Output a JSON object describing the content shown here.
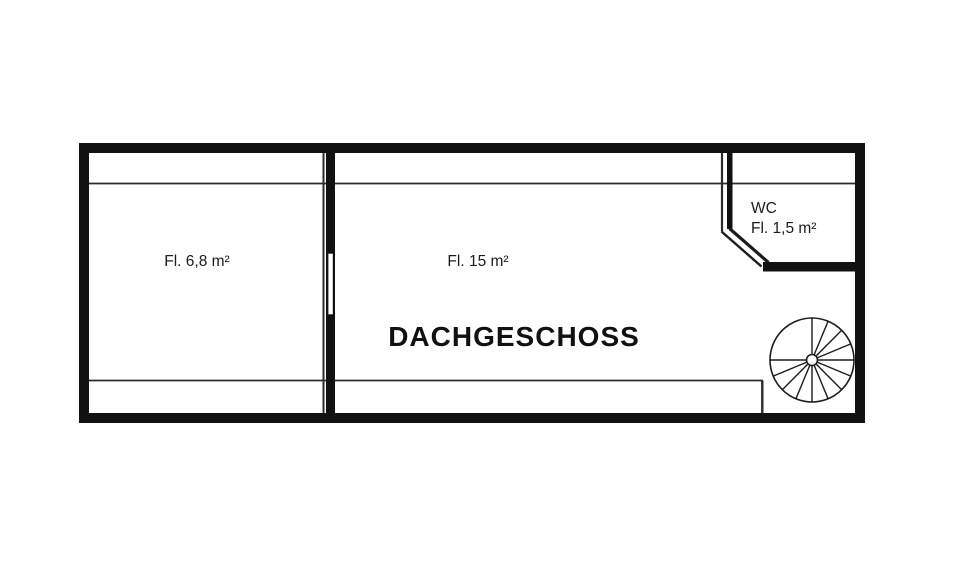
{
  "plan": {
    "title": "DACHGESCHOSS",
    "rooms": [
      {
        "name": "left-room",
        "label": "Fl. 6,8 m²"
      },
      {
        "name": "main-room",
        "label": "Fl. 15 m²"
      },
      {
        "name": "wc",
        "label": "WC",
        "area_label": "Fl. 1,5 m²"
      }
    ],
    "features": [
      {
        "name": "spiral-staircase"
      },
      {
        "name": "door-opening-main-wall"
      }
    ],
    "colors": {
      "wall": "#111111",
      "thin_line": "#2b2b2b",
      "background": "#ffffff"
    }
  }
}
